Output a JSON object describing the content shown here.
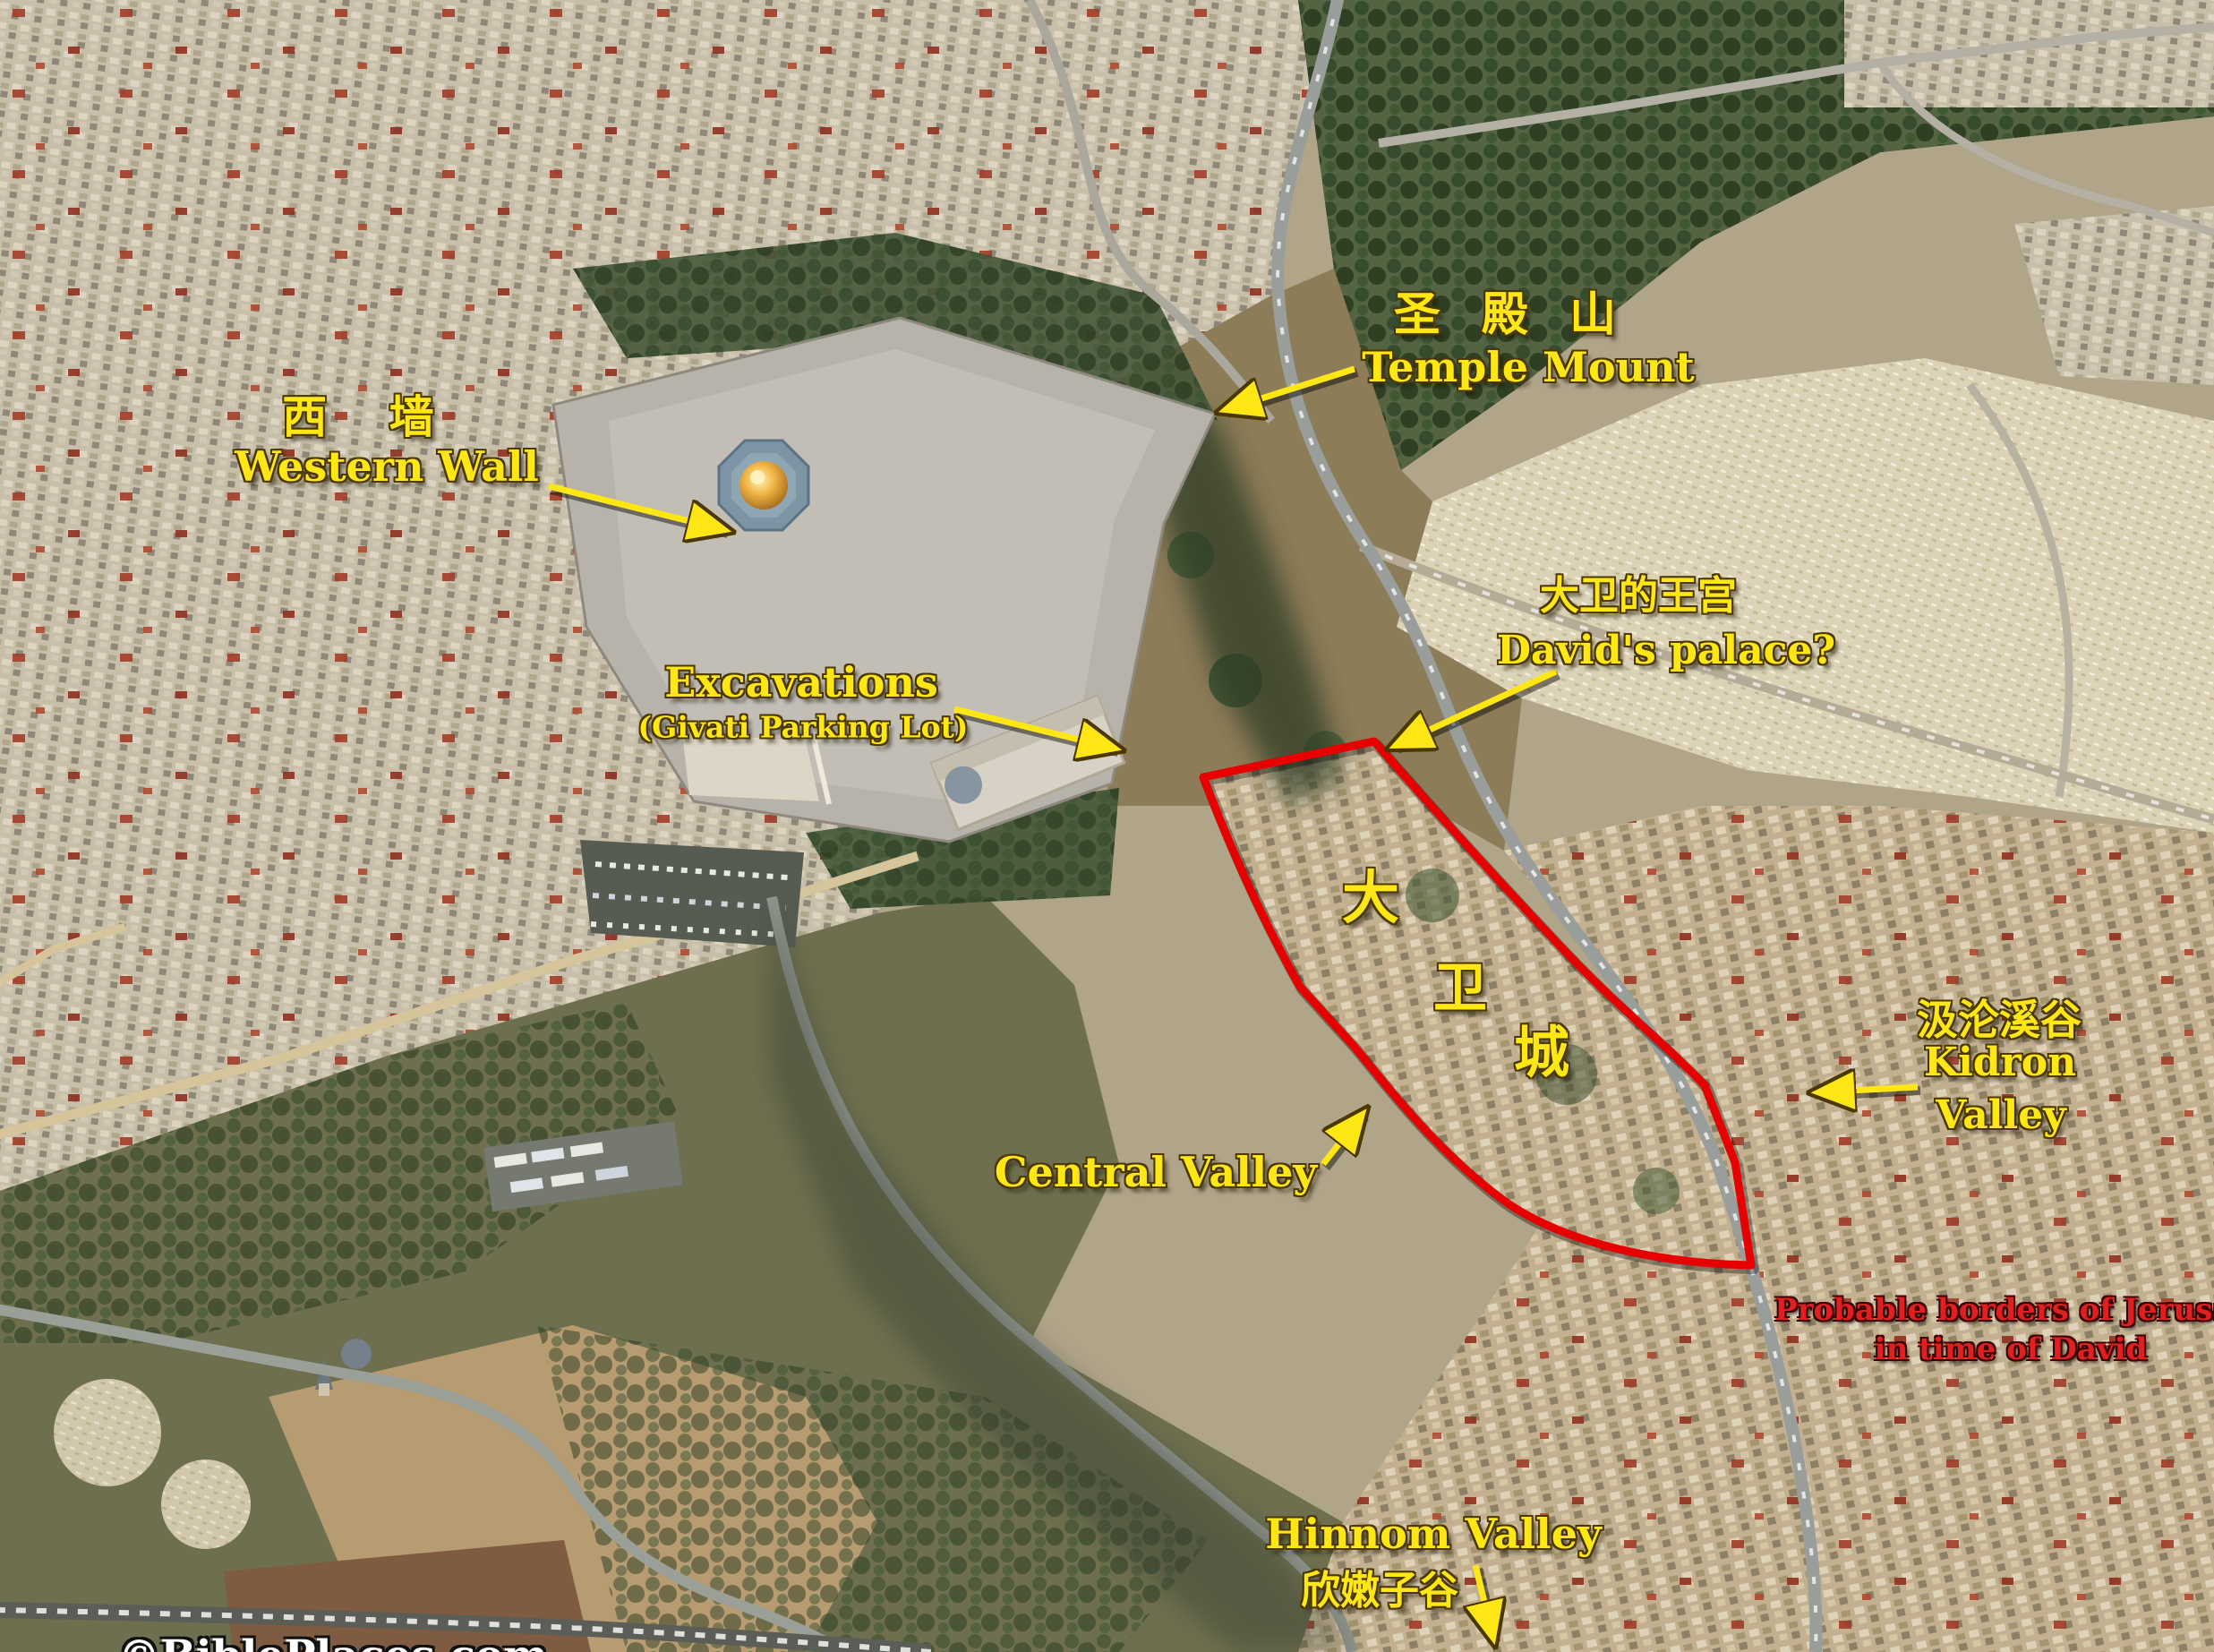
{
  "colors": {
    "label_yellow": "#ffe615",
    "caption_red": "#e02020",
    "boundary_red": "#e60000",
    "watermark_white": "#ffffff",
    "dome_gold": "#e8a93d"
  },
  "labels": {
    "temple_mount": {
      "zh": "圣 殿 山",
      "en": "Temple Mount"
    },
    "western_wall": {
      "zh": "西  墙",
      "en": "Western Wall"
    },
    "excavations": {
      "title": "Excavations",
      "subtitle": "(Givati Parking Lot)"
    },
    "davids_palace": {
      "zh": "大卫的王宫",
      "en": "David's palace?"
    },
    "city_of_david": {
      "chars": [
        "大",
        "卫",
        "城"
      ]
    },
    "kidron_valley": {
      "zh": "汲沦溪谷",
      "en_line1": "Kidron",
      "en_line2": "Valley"
    },
    "central_valley": {
      "en": "Central Valley"
    },
    "hinnom_valley": {
      "en": "Hinnom Valley",
      "zh": "欣嫩子谷"
    },
    "borders_caption": {
      "line1": "Probable borders of Jerusalem",
      "line2": "in time of David"
    },
    "watermark": {
      "text": "©BiblePlaces.com"
    }
  }
}
